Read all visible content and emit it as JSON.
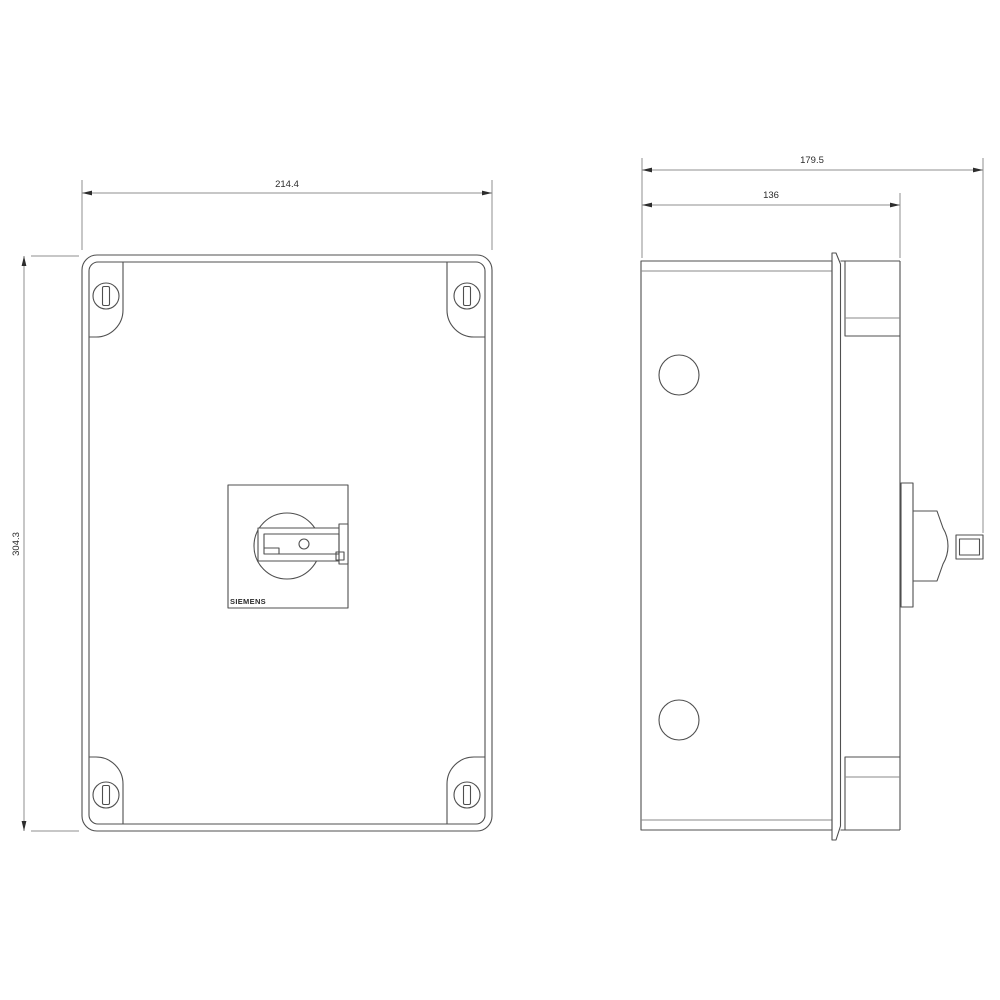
{
  "drawing": {
    "title": "enclosure-dimensional-drawing",
    "front": {
      "brand": "SIEMENS",
      "width_dim": "214.4",
      "height_dim": "304.3"
    },
    "side": {
      "overall_depth_dim": "179.5",
      "body_depth_dim": "136"
    },
    "colors": {
      "background": "#ffffff",
      "outline": "#4f4f4f",
      "light_line": "#8a8a8a",
      "dimension_line": "#8f8f8f",
      "text": "#2b2b2b"
    }
  }
}
